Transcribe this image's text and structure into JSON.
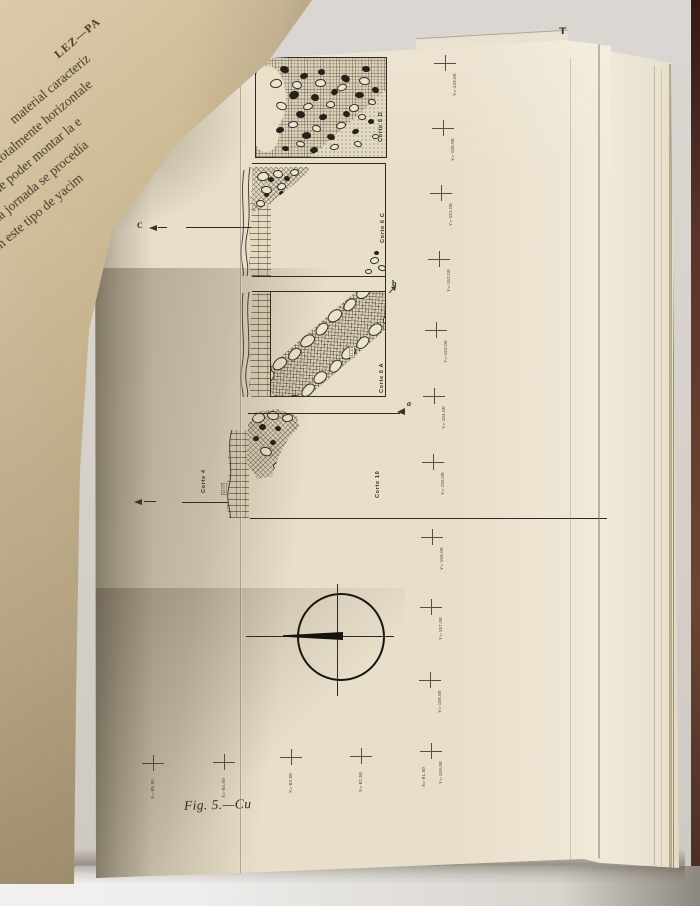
{
  "book": {
    "caption": "Fig. 5.—Cu",
    "prev_page_text": [
      "LEZ—PA",
      "material caracteriz",
      "totalmente horizontale",
      "de poder montar la e",
      "ada jornada se procedía",
      "en este tipo de yacim"
    ],
    "corner_mark": "T"
  },
  "figure": {
    "sections": [
      {
        "id": "corte-6d",
        "label": "Corte 6 D"
      },
      {
        "id": "corte-6c",
        "label": "Corte 6 C"
      },
      {
        "id": "corte-6a",
        "label": "Corte 6 A"
      },
      {
        "id": "corte-4",
        "label": "Corte 4"
      },
      {
        "id": "corte-10",
        "label": "Corte 10"
      }
    ],
    "section_markers": {
      "c": "C",
      "a": "a",
      "b": "b"
    },
    "elevations": {
      "band": "41.14",
      "wall": "43.97"
    },
    "grid_crosses": {
      "y_axis": [
        {
          "x": 445,
          "y": 63,
          "label": "Y=-149.00"
        },
        {
          "x": 443,
          "y": 128,
          "label": "Y=-150.00"
        },
        {
          "x": 441,
          "y": 193,
          "label": "Y=-151.00"
        },
        {
          "x": 439,
          "y": 259,
          "label": "Y=-152.00"
        },
        {
          "x": 436,
          "y": 330,
          "label": "Y=-153.00"
        },
        {
          "x": 434,
          "y": 396,
          "label": "Y=-154.00"
        },
        {
          "x": 433,
          "y": 462,
          "label": "Y=-155.00"
        },
        {
          "x": 432,
          "y": 537,
          "label": "Y=-156.00"
        },
        {
          "x": 431,
          "y": 607,
          "label": "Y=-157.00"
        },
        {
          "x": 430,
          "y": 680,
          "label": "Y=-158.00"
        },
        {
          "x": 431,
          "y": 751,
          "label": "Y=-159.00",
          "label2": "X=-81.50"
        }
      ],
      "x_axis": [
        {
          "x": 153,
          "y": 763,
          "label": "X=-85.50"
        },
        {
          "x": 224,
          "y": 762,
          "label": "X=-84.50"
        },
        {
          "x": 291,
          "y": 757,
          "label": "X=-83.50"
        },
        {
          "x": 361,
          "y": 756,
          "label": "X=-82.50"
        }
      ]
    },
    "stones": {
      "corte6d": [
        [
          "d",
          24,
          8,
          9,
          7,
          20
        ],
        [
          "d",
          44,
          15,
          8,
          6,
          -15
        ],
        [
          "d",
          62,
          11,
          7,
          6,
          0
        ],
        [
          "d",
          85,
          17,
          9,
          7,
          30
        ],
        [
          "d",
          106,
          8,
          8,
          6,
          10
        ],
        [
          "d",
          33,
          33,
          10,
          8,
          -20
        ],
        [
          "d",
          55,
          36,
          8,
          7,
          15
        ],
        [
          "d",
          75,
          31,
          7,
          6,
          -30
        ],
        [
          "d",
          99,
          34,
          9,
          6,
          0
        ],
        [
          "d",
          116,
          29,
          7,
          6,
          20
        ],
        [
          "d",
          40,
          53,
          9,
          7,
          10
        ],
        [
          "d",
          63,
          56,
          8,
          6,
          -10
        ],
        [
          "d",
          87,
          53,
          7,
          6,
          25
        ],
        [
          "d",
          20,
          69,
          8,
          6,
          -15
        ],
        [
          "d",
          46,
          74,
          9,
          7,
          0
        ],
        [
          "d",
          71,
          76,
          8,
          6,
          15
        ],
        [
          "d",
          96,
          71,
          7,
          5,
          -20
        ],
        [
          "d",
          112,
          61,
          6,
          5,
          0
        ],
        [
          "d",
          26,
          88,
          7,
          5,
          10
        ],
        [
          "d",
          54,
          89,
          8,
          6,
          -10
        ],
        [
          "l",
          14,
          21,
          12,
          9,
          -10
        ],
        [
          "l",
          36,
          23,
          10,
          8,
          15
        ],
        [
          "l",
          59,
          21,
          11,
          8,
          0
        ],
        [
          "l",
          81,
          26,
          10,
          7,
          -20
        ],
        [
          "l",
          103,
          19,
          11,
          8,
          10
        ],
        [
          "l",
          20,
          44,
          11,
          8,
          20
        ],
        [
          "l",
          47,
          45,
          10,
          7,
          -15
        ],
        [
          "l",
          70,
          43,
          9,
          7,
          0
        ],
        [
          "l",
          93,
          46,
          10,
          8,
          -10
        ],
        [
          "l",
          112,
          41,
          8,
          6,
          15
        ],
        [
          "l",
          32,
          63,
          10,
          7,
          -5
        ],
        [
          "l",
          56,
          67,
          9,
          7,
          20
        ],
        [
          "l",
          80,
          64,
          10,
          7,
          -15
        ],
        [
          "l",
          102,
          56,
          8,
          6,
          0
        ],
        [
          "l",
          40,
          83,
          9,
          6,
          10
        ],
        [
          "l",
          74,
          86,
          9,
          6,
          -10
        ],
        [
          "l",
          98,
          83,
          8,
          6,
          20
        ],
        [
          "l",
          116,
          76,
          7,
          5,
          0
        ]
      ],
      "corte6c_rubble": [
        [
          "l",
          5,
          5,
          12,
          9,
          -10
        ],
        [
          "l",
          21,
          3,
          10,
          8,
          12
        ],
        [
          "l",
          38,
          2,
          9,
          7,
          -5
        ],
        [
          "l",
          9,
          19,
          11,
          8,
          8
        ],
        [
          "l",
          25,
          16,
          9,
          7,
          -12
        ],
        [
          "l",
          4,
          33,
          9,
          7,
          5
        ],
        [
          "d",
          16,
          10,
          6,
          5,
          0
        ],
        [
          "d",
          32,
          9,
          6,
          5,
          20
        ],
        [
          "d",
          12,
          26,
          5,
          4,
          0
        ],
        [
          "d",
          27,
          24,
          5,
          4,
          -15
        ],
        [
          "d",
          19,
          38,
          5,
          4,
          10
        ]
      ],
      "corte6c_right": [
        [
          "l",
          8,
          11,
          9,
          7,
          -10
        ],
        [
          "l",
          16,
          19,
          8,
          6,
          15
        ],
        [
          "l",
          3,
          23,
          7,
          5,
          0
        ],
        [
          "d",
          12,
          5,
          5,
          4,
          0
        ]
      ],
      "corte6a_band": [
        [
          "l",
          0,
          1,
          15,
          11,
          -6
        ],
        [
          "l",
          17,
          -1,
          16,
          11,
          4
        ],
        [
          "l",
          35,
          2,
          15,
          10,
          -3
        ],
        [
          "l",
          53,
          0,
          16,
          11,
          6
        ],
        [
          "l",
          72,
          1,
          15,
          10,
          -5
        ],
        [
          "l",
          90,
          -1,
          16,
          11,
          3
        ],
        [
          "l",
          109,
          1,
          15,
          10,
          -4
        ],
        [
          "l",
          127,
          0,
          15,
          11,
          5
        ],
        [
          "l",
          3,
          36,
          15,
          11,
          5
        ],
        [
          "l",
          21,
          38,
          16,
          10,
          -4
        ],
        [
          "l",
          39,
          36,
          15,
          11,
          3
        ],
        [
          "l",
          58,
          38,
          15,
          10,
          -6
        ],
        [
          "l",
          76,
          36,
          16,
          11,
          4
        ],
        [
          "l",
          94,
          38,
          15,
          10,
          -3
        ],
        [
          "l",
          112,
          36,
          15,
          11,
          6
        ],
        [
          "l",
          130,
          37,
          14,
          10,
          -5
        ]
      ],
      "corte4_rubble": [
        [
          "l",
          5,
          4,
          13,
          10,
          -15
        ],
        [
          "l",
          20,
          2,
          12,
          9,
          10
        ],
        [
          "l",
          35,
          5,
          11,
          8,
          -5
        ],
        [
          "l",
          13,
          38,
          12,
          9,
          20
        ],
        [
          "l",
          26,
          53,
          10,
          8,
          -8
        ],
        [
          "d",
          12,
          15,
          7,
          6,
          0
        ],
        [
          "d",
          28,
          17,
          6,
          5,
          15
        ],
        [
          "d",
          6,
          27,
          6,
          5,
          -10
        ],
        [
          "d",
          23,
          31,
          6,
          5,
          5
        ],
        [
          "d",
          33,
          44,
          6,
          5,
          0
        ]
      ]
    }
  },
  "colors": {
    "ink": "#2e2a24",
    "paper": "#e8dfca",
    "prev_page_paper": "#c9b58e",
    "background_wall": "#d6d2cb",
    "cover_strip": "#5c352a",
    "table": "#e7e5e1"
  }
}
